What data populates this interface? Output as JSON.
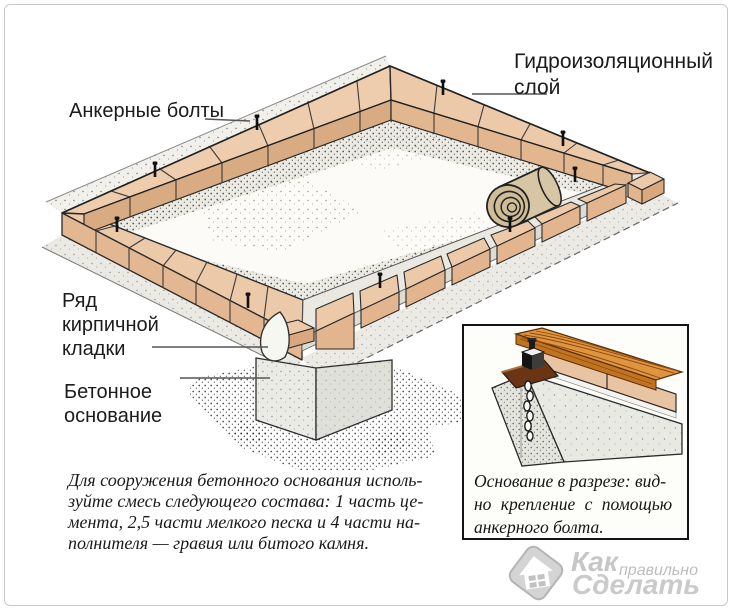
{
  "page": {
    "background": "#ffffff",
    "frame_color": "#c9c9c9"
  },
  "colors": {
    "brick_top": "#eccaa9",
    "brick_face": "#e2b58e",
    "concrete": "#e9e8e1",
    "outline": "#2a2a2a",
    "wood": "#df9440",
    "watermark": "#c6c6c6"
  },
  "labels": {
    "anchor_bolts": "Анкерные болты",
    "waterproofing": {
      "line1": "Гидроизоляционный",
      "line2": "слой"
    },
    "brick_row": {
      "line1": "Ряд",
      "line2": "кирпичной",
      "line3": "кладки"
    },
    "concrete_base": {
      "line1": "Бетонное",
      "line2": "основание"
    }
  },
  "note": {
    "line1": "Для сооружения бетонного основания исполь-",
    "line2": "зуйте смесь следующего состава: 1 часть це-",
    "line3": "мента, 2,5 части мелкого песка и 4 части на-",
    "line4": "полнителя — гравия или битого камня."
  },
  "inset": {
    "caption": {
      "line1": "Основание в разрезе: вид-",
      "line2": "но крепление с помощью",
      "line3": "анкерного болта."
    }
  },
  "watermark": {
    "word1": "Как",
    "word2": "правильно",
    "word3": "Сделать"
  }
}
